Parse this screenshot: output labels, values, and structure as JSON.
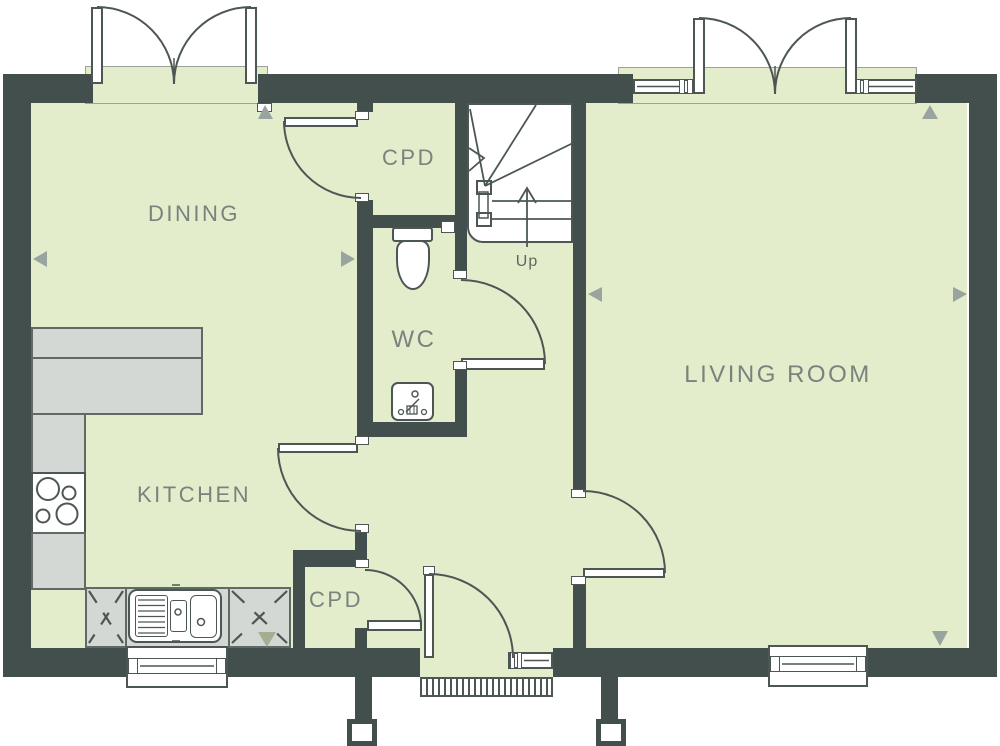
{
  "plan": {
    "type": "floor-plan",
    "rooms": {
      "dining": {
        "label": "DINING"
      },
      "kitchen": {
        "label": "KITCHEN"
      },
      "wc": {
        "label": "WC"
      },
      "cpd_top": {
        "label": "CPD"
      },
      "cpd_bottom": {
        "label": "CPD"
      },
      "living": {
        "label": "LIVING ROOM"
      }
    },
    "stairs": {
      "direction_label": "Up"
    },
    "fixtures": [
      "french-doors-dining",
      "french-doors-living",
      "window-living-top-left",
      "window-living-top-right",
      "window-kitchen-bottom",
      "window-living-bottom",
      "sidelight-front-door",
      "kitchen-counter",
      "hob",
      "kitchen-sink",
      "toilet",
      "wash-basin",
      "staircase-up",
      "front-door",
      "entrance-mat",
      "porch-post-left",
      "porch-post-right"
    ]
  },
  "palette": {
    "wall": "#434f4d",
    "floor": "#e4edcb",
    "band_border": "#9aa39b",
    "counter": "#d4d8d4",
    "counter_border": "#5f6a67",
    "line": "#4c5755",
    "label": "#78837e",
    "marker": "#9aa49f",
    "marker_olive": "#a4ae90"
  }
}
